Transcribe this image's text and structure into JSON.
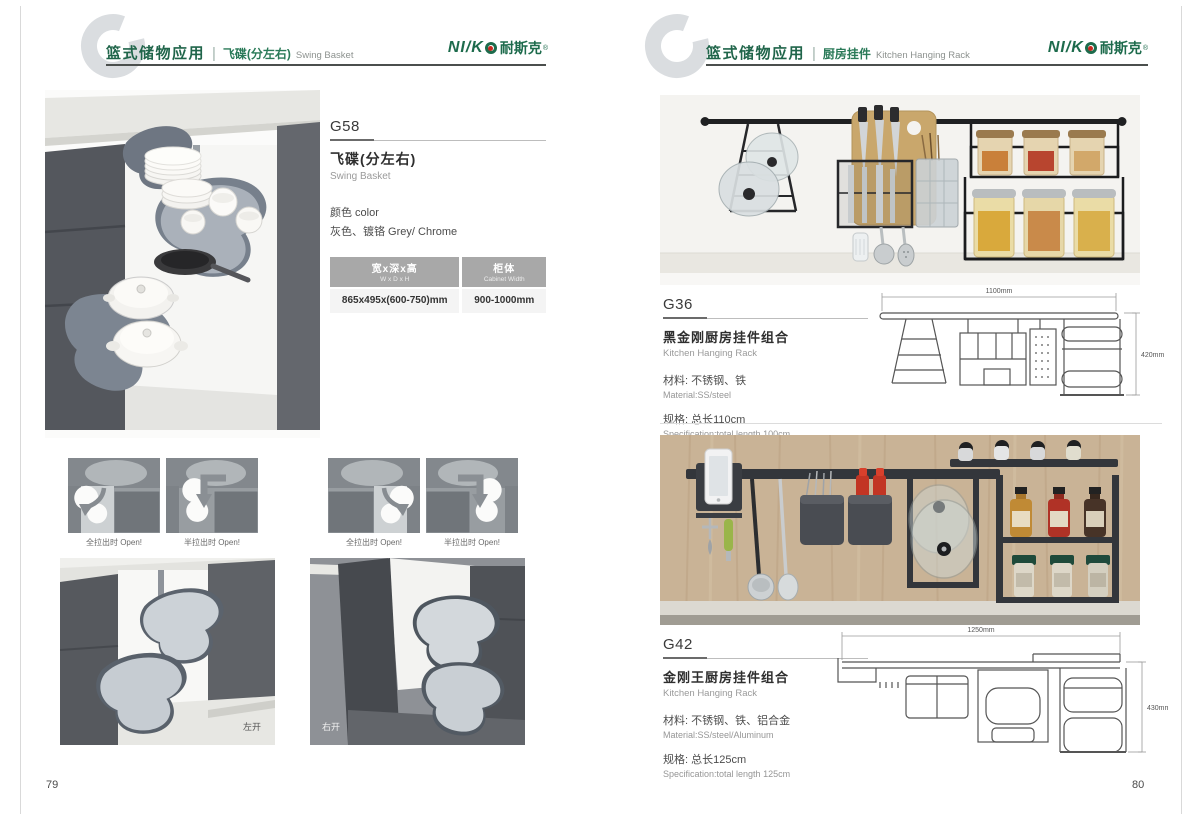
{
  "brand": {
    "logo_en": "NI/K",
    "logo_cn": "耐斯克",
    "logo_reg": "®"
  },
  "left_page": {
    "page_number": "79",
    "header": {
      "category": "篮式储物应用",
      "item_cn": "飞碟(分左右)",
      "item_en": "Swing Basket"
    },
    "product": {
      "code": "G58",
      "name_cn": "飞碟(分左右)",
      "name_en": "Swing Basket",
      "color_label": "颜色 color",
      "color_value": "灰色、镀铬 Grey/ Chrome",
      "spec_table": {
        "columns": [
          {
            "header_cn": "宽x深x高",
            "header_en": "W x D x H",
            "value": "865x495x(600-750)mm"
          },
          {
            "header_cn": "柜体",
            "header_en": "Cabinet Width",
            "value": "900-1000mm"
          }
        ]
      }
    },
    "open_diagrams": {
      "full_label": "全拉出时 Open!",
      "half_label": "半拉出时 Open!"
    },
    "photos": {
      "left_open_caption": "左开",
      "right_open_caption": "右开"
    }
  },
  "right_page": {
    "page_number": "80",
    "header": {
      "category": "篮式储物应用",
      "item_cn": "厨房挂件",
      "item_en": "Kitchen Hanging Rack"
    },
    "g36": {
      "code": "G36",
      "name_cn": "黑金刚厨房挂件组合",
      "name_en": "Kitchen Hanging Rack",
      "material_cn": "材料: 不锈钢、铁",
      "material_en": "Material:SS/steel",
      "spec_cn": "规格: 总长110cm",
      "spec_en": "Specification:total length 100cm",
      "drawing": {
        "width_label": "1100mm",
        "height_label": "420mm"
      }
    },
    "g42": {
      "code": "G42",
      "name_cn": "金刚王厨房挂件组合",
      "name_en": "Kitchen Hanging Rack",
      "material_cn": "材料: 不锈钢、铁、铝合金",
      "material_en": "Material:SS/steel/Aluminum",
      "spec_cn": "规格: 总长125cm",
      "spec_en": "Specification:total length 125cm",
      "drawing": {
        "width_label": "1250mm",
        "height_label": "430mm"
      }
    }
  }
}
